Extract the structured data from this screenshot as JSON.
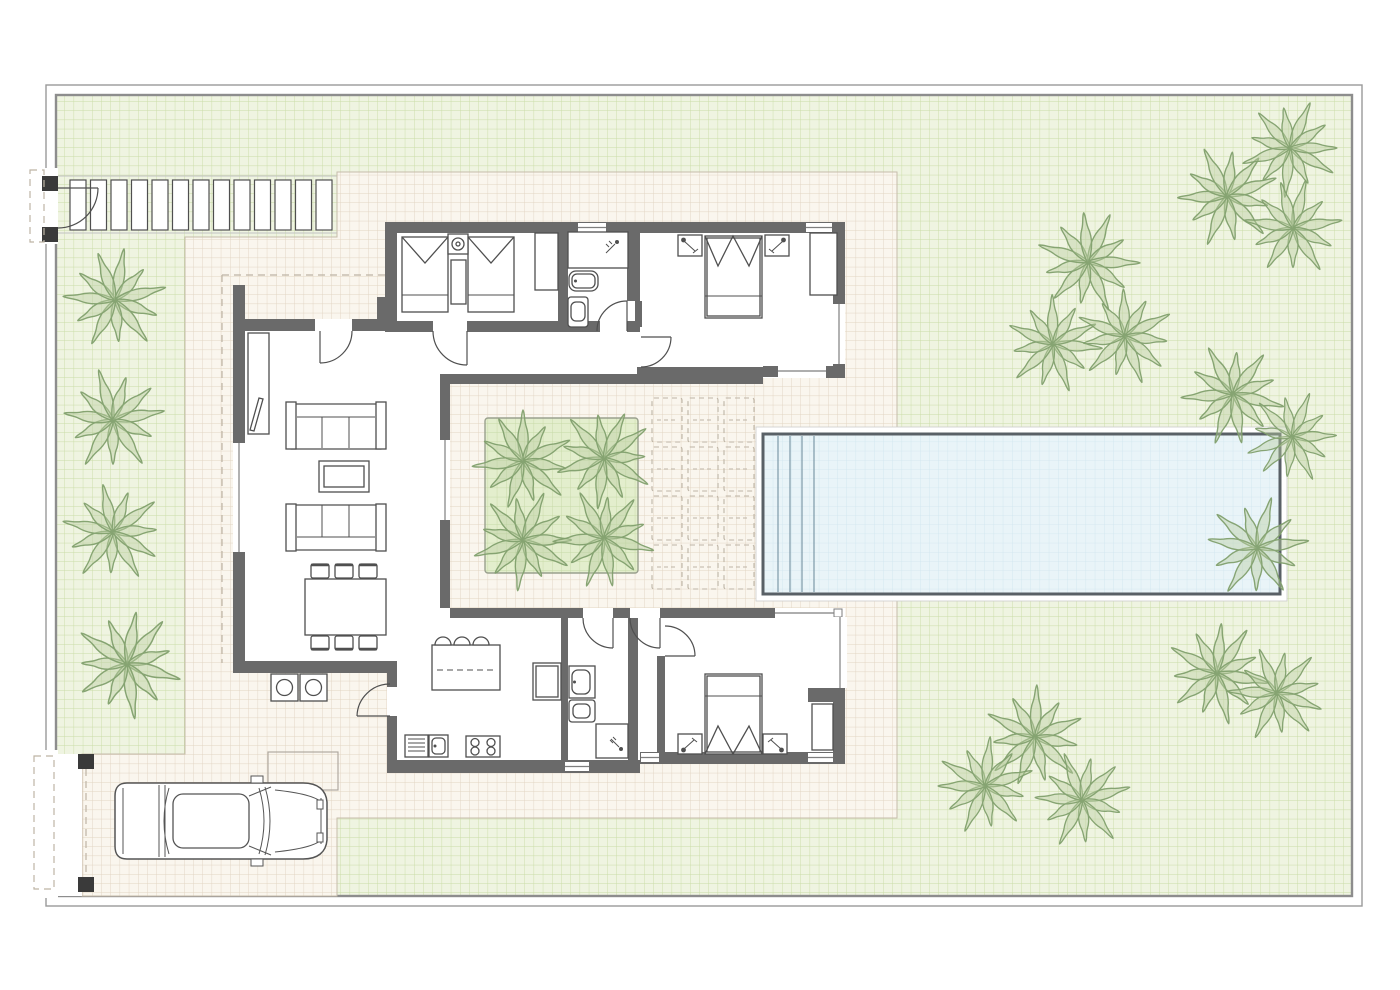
{
  "title": "Villa site plan with garden, pool and parking",
  "palette": {
    "wall": "#6a6a6a",
    "line": "#4f4f4f",
    "lawn": "#eff4e1",
    "lawn_grid": "#c9dca6",
    "terrace": "#faf6ee",
    "terrace_grid": "#e1d4c2",
    "planter": "#e3eecd",
    "planter_grid": "#c6d9a6",
    "water": "#e9f4f8",
    "water_grid": "#cfe5ee",
    "palm_stroke": "#81a06d",
    "palm_fill": "#b7cda0",
    "border": "#909090",
    "dash": "#bdb4a5"
  },
  "site": {
    "plot_border": "double line",
    "entrance_gate_position": "top-left",
    "driveway_gate_position": "bottom-left",
    "vehicles": 1
  },
  "entrance": {
    "stepping_stones": 13,
    "stone_w": 16,
    "stone_h": 50,
    "x0": 70,
    "y0": 180,
    "step": 20.5
  },
  "pool": {
    "shape": "rectangular",
    "x": 763,
    "y": 434,
    "w": 517,
    "h": 160,
    "steps": 4,
    "step_x0": 778,
    "step_dx": 12
  },
  "courtyard": {
    "planter_palms": 4,
    "loungers": {
      "cols": 3,
      "rows": 4,
      "x0": 652,
      "y0": 398,
      "w": 30,
      "h": 44,
      "dx": 36,
      "dy": 49
    }
  },
  "rooms": [
    "living-dining",
    "kitchen",
    "hall",
    "bedroom-twin",
    "bathroom-top",
    "bedroom-master",
    "vestibule",
    "bathroom-bottom",
    "bedroom-bottom",
    "outdoor-bbq-nook"
  ],
  "garden": {
    "palm_trees": [
      {
        "x": 115,
        "y": 300,
        "s": 1.0,
        "r": 10
      },
      {
        "x": 113,
        "y": 420,
        "s": 1.0,
        "r": 80
      },
      {
        "x": 113,
        "y": 532,
        "s": 0.98,
        "r": 150
      },
      {
        "x": 127,
        "y": 664,
        "s": 1.06,
        "r": 40
      },
      {
        "x": 523,
        "y": 461,
        "s": 0.98,
        "r": 0
      },
      {
        "x": 604,
        "y": 458,
        "s": 0.98,
        "r": 55
      },
      {
        "x": 523,
        "y": 540,
        "s": 0.98,
        "r": 120
      },
      {
        "x": 604,
        "y": 538,
        "s": 0.98,
        "r": 200
      },
      {
        "x": 1088,
        "y": 262,
        "s": 1.0,
        "r": 25
      },
      {
        "x": 1053,
        "y": 344,
        "s": 0.95,
        "r": 95
      },
      {
        "x": 1125,
        "y": 336,
        "s": 0.95,
        "r": 160
      },
      {
        "x": 1227,
        "y": 196,
        "s": 1.0,
        "r": 70
      },
      {
        "x": 1290,
        "y": 148,
        "s": 0.95,
        "r": 120
      },
      {
        "x": 1293,
        "y": 228,
        "s": 0.95,
        "r": 15
      },
      {
        "x": 1233,
        "y": 394,
        "s": 1.0,
        "r": 200
      },
      {
        "x": 1292,
        "y": 437,
        "s": 0.9,
        "r": 250
      },
      {
        "x": 1257,
        "y": 548,
        "s": 1.0,
        "r": 310
      },
      {
        "x": 1217,
        "y": 673,
        "s": 1.0,
        "r": 35
      },
      {
        "x": 1277,
        "y": 693,
        "s": 0.95,
        "r": 140
      },
      {
        "x": 1035,
        "y": 737,
        "s": 1.0,
        "r": 230
      },
      {
        "x": 985,
        "y": 786,
        "s": 0.95,
        "r": 300
      },
      {
        "x": 1082,
        "y": 800,
        "s": 0.95,
        "r": 75
      }
    ]
  }
}
